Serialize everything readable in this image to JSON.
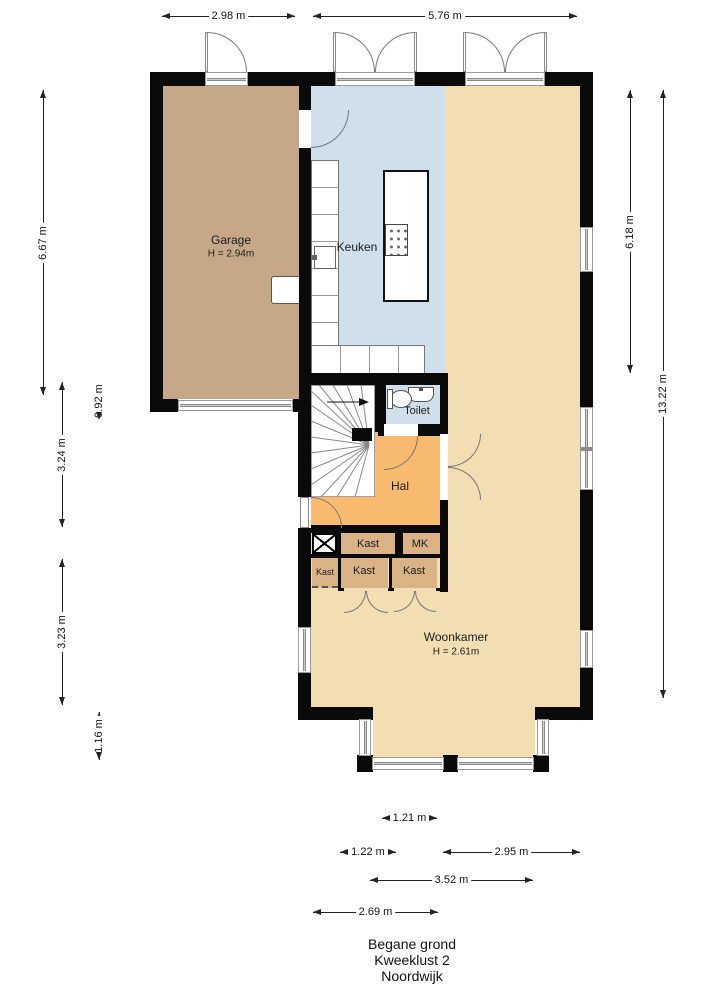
{
  "title": {
    "line1": "Begane grond",
    "line2": "Kweeklust 2",
    "line3": "Noordwijk"
  },
  "rooms": {
    "garage": {
      "label": "Garage",
      "height": "H = 2.94m",
      "color": "#c6a888"
    },
    "keuken": {
      "label": "Keuken",
      "color": "#cfdfec"
    },
    "toilet": {
      "label": "Toilet",
      "color": "#cfdfec"
    },
    "hal": {
      "label": "Hal",
      "color": "#f8ba6e"
    },
    "woonkamer": {
      "label": "Woonkamer",
      "height": "H = 2.61m",
      "color": "#f3ddb2"
    },
    "kast_top": {
      "label": "Kast",
      "color": "#d9b286"
    },
    "mk": {
      "label": "MK",
      "color": "#d9b286"
    },
    "kast_left": {
      "label": "Kast",
      "color": "#d9b286"
    },
    "kast_mid": {
      "label": "Kast",
      "color": "#d9b286"
    },
    "kast_right": {
      "label": "Kast",
      "color": "#d9b286"
    }
  },
  "dims": {
    "top_garage": "2.98 m",
    "top_main": "5.76 m",
    "left_garage": "6.67 m",
    "left_mid": "3.24 m",
    "left_offset": "0.92 m",
    "left_lower": "3.23 m",
    "left_bay": "1.16 m",
    "right_upper": "6.18 m",
    "right_total": "13.22 m",
    "bottom_bay_inner": "1.21 m",
    "bottom_left": "1.22 m",
    "bottom_right": "2.95 m",
    "bottom_bay": "3.52 m",
    "bottom_front": "2.69 m"
  },
  "colors": {
    "wall": "#0a0a0a",
    "window_frame": "#9a9a9a",
    "background": "#ffffff"
  }
}
